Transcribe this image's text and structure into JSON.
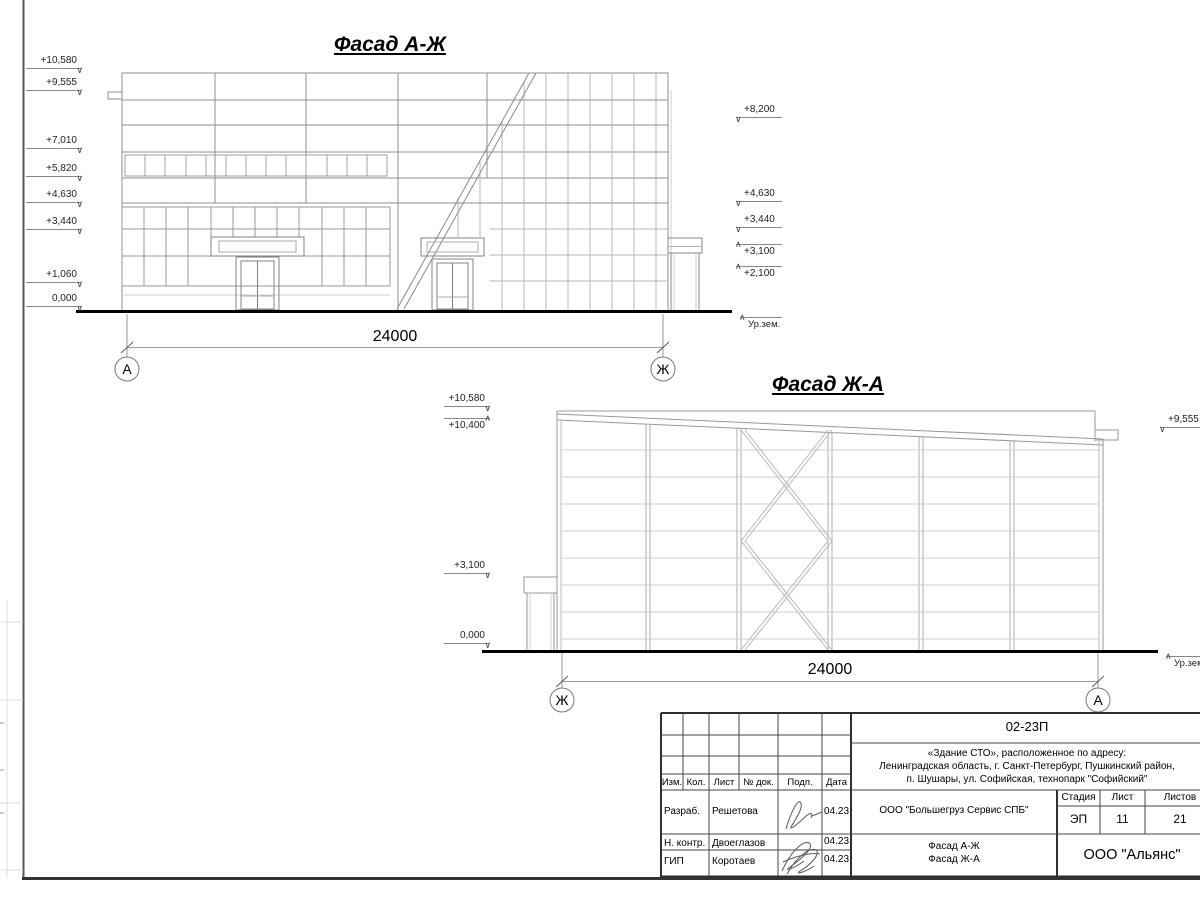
{
  "facade1": {
    "title": "Фасад А-Ж",
    "dim": "24000",
    "axis_left": "А",
    "axis_right": "Ж",
    "marks_left": [
      "+10,580",
      "+9,555",
      "+7,010",
      "+5,820",
      "+4,630",
      "+3,440",
      "+1,060",
      "0,000"
    ],
    "marks_right": [
      "+8,200",
      "+4,630",
      "+3,440",
      "+3,100",
      "+2,100"
    ],
    "ground": "Ур.зем."
  },
  "facade2": {
    "title": "Фасад Ж-А",
    "dim": "24000",
    "axis_left": "Ж",
    "axis_right": "А",
    "marks_left": [
      "+10,580",
      "+10,400",
      "+3,100",
      "0,000"
    ],
    "marks_right": [
      "+9,555"
    ],
    "ground": "Ур.зем."
  },
  "titleblock": {
    "code": "02-23П",
    "address_lines": [
      "«Здание СТО», расположенное по адресу:",
      "Ленинградская область, г. Санкт-Петербург, Пушкинский район,",
      "п. Шушары, ул. Софийская, технопарк \"Софийский\""
    ],
    "rev_cols": [
      "Изм.",
      "Кол.",
      "Лист",
      "№ док.",
      "Подп.",
      "Дата"
    ],
    "rows": [
      {
        "role": "Разраб.",
        "name": "Решетова",
        "date": "04.23"
      },
      {
        "role": "Н. контр.",
        "name": "Двоеглазов",
        "date": "04.23"
      },
      {
        "role": "ГИП",
        "name": "Коротаев",
        "date": "04.23"
      }
    ],
    "company": "ООО \"Большегруз Сервис СПБ\"",
    "stage_label": "Стадия",
    "sheet_label": "Лист",
    "sheets_label": "Листов",
    "stage": "ЭП",
    "sheet": "11",
    "sheets": "21",
    "doc_titles": [
      "Фасад А-Ж",
      "Фасад Ж-А"
    ],
    "firm": "ООО \"Альянс\""
  }
}
